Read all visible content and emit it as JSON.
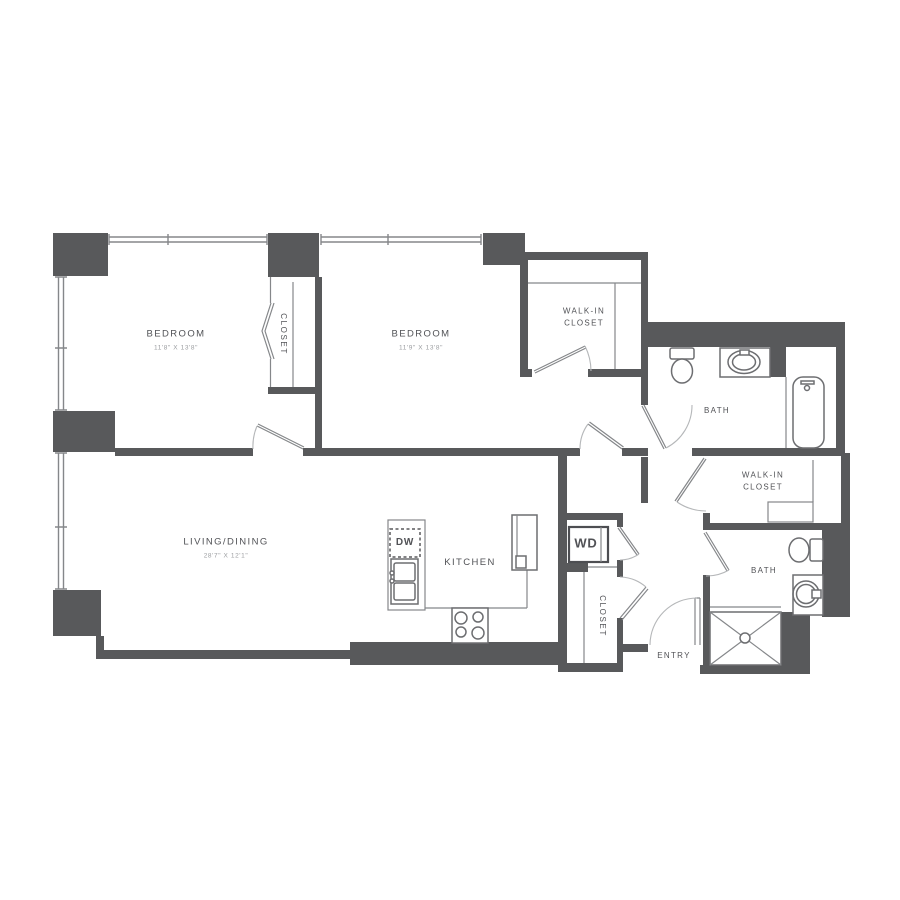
{
  "colors": {
    "wall": "#58595b",
    "line": "#85878a",
    "fixture": "#6d6e71",
    "arc": "#b5b7b9",
    "label": "#515256",
    "dim": "#9b9da0"
  },
  "labels": {
    "bedroom1": {
      "name": "BEDROOM",
      "dims": "11'8\" X 13'8\""
    },
    "bedroom2": {
      "name": "BEDROOM",
      "dims": "11'9\" X 13'8\""
    },
    "living": {
      "name": "LIVING/DINING",
      "dims": "28'7\" X 12'1\""
    },
    "kitchen": "KITCHEN",
    "bath1": "BATH",
    "bath2": "BATH",
    "walk_in_closet1": "WALK-IN\nCLOSET",
    "walk_in_closet2": "WALK-IN\nCLOSET",
    "closet_bedroom": "CLOSET",
    "closet_hall": "CLOSET",
    "entry": "ENTRY",
    "dishwasher": "DW",
    "washer_dryer": "WD"
  },
  "fixtures": [
    "toilet",
    "vanity-sink",
    "bathtub",
    "toilet",
    "round-sink",
    "shower",
    "stove",
    "kitchen-sink",
    "dishwasher",
    "refrigerator",
    "washer-dryer"
  ]
}
